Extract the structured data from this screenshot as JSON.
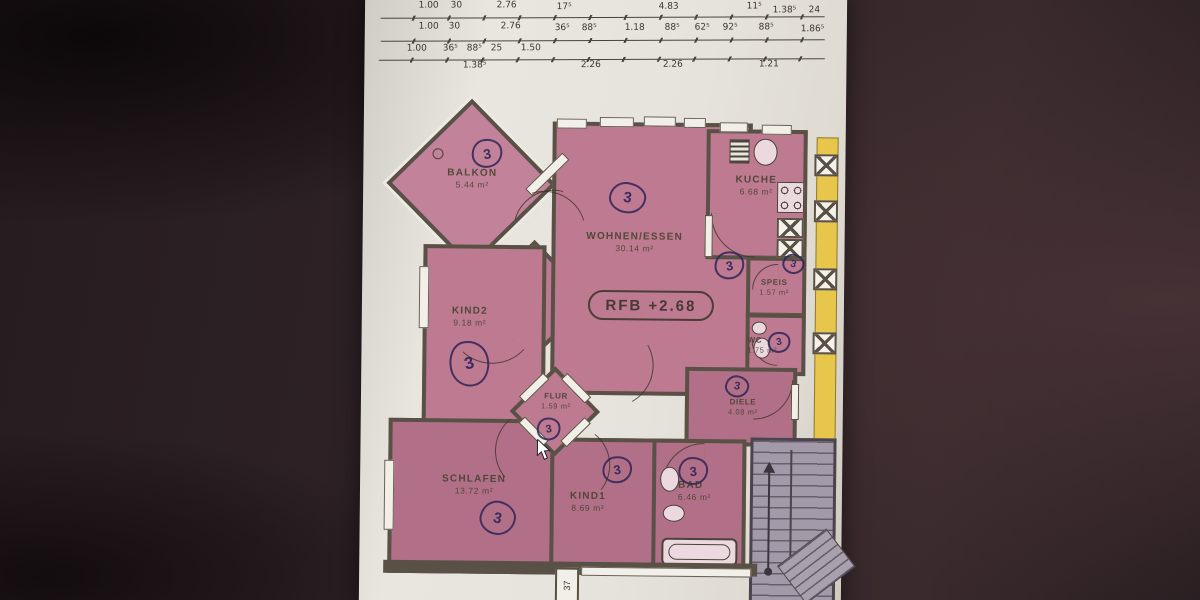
{
  "dims": {
    "row1": [
      "1.00",
      "30",
      "2.76",
      "17⁵",
      "4.83",
      "11⁵",
      "1.38⁵",
      "24"
    ],
    "row2": [
      "1.00",
      "30",
      "2.76",
      "36⁵",
      "88⁵",
      "1.18",
      "88⁵",
      "62⁵",
      "92⁵",
      "88⁵",
      "1.86⁵"
    ],
    "row3": [
      "1.00",
      "36⁵",
      "88⁵",
      "25",
      "1.50",
      "2.26",
      "2.26",
      "1.21"
    ],
    "row3_sub": "1.38⁵",
    "bottom_vertical": "37"
  },
  "level_label": "RFB +2.68",
  "rooms": {
    "balkon": {
      "name": "BALKON",
      "area": "5.44 m²",
      "mark": "3"
    },
    "wohnen": {
      "name": "WOHNEN/ESSEN",
      "area": "30.14 m²",
      "mark": "3"
    },
    "kueche": {
      "name": "KUCHE",
      "area": "6.68 m²",
      "mark": "3"
    },
    "speis": {
      "name": "SPEIS",
      "area": "1.57 m²",
      "mark": "3"
    },
    "wc": {
      "name": "WC",
      "area": "1.75 m²",
      "mark": "3"
    },
    "kind2": {
      "name": "KIND2",
      "area": "9.18 m²",
      "mark": "3"
    },
    "flur": {
      "name": "FLUR",
      "area": "1.59 m²",
      "mark": "3"
    },
    "diele": {
      "name": "DIELE",
      "area": "4.08 m²",
      "mark": "3"
    },
    "schlafen": {
      "name": "SCHLAFEN",
      "area": "13.72 m²",
      "mark": "3"
    },
    "kind1": {
      "name": "KIND1",
      "area": "8.69 m²",
      "mark": "3"
    },
    "bad": {
      "name": "BAD",
      "area": "6.46 m²",
      "mark": "3"
    }
  },
  "colors": {
    "room_pink": "#bd7a90",
    "wall": "#5a5146",
    "paper": "#e7e4dd",
    "background": "#2e2226",
    "pen_ink": "#2e2358",
    "neighbor_yellow": "#e7c64b",
    "stairs_grey": "#a29aa8"
  }
}
